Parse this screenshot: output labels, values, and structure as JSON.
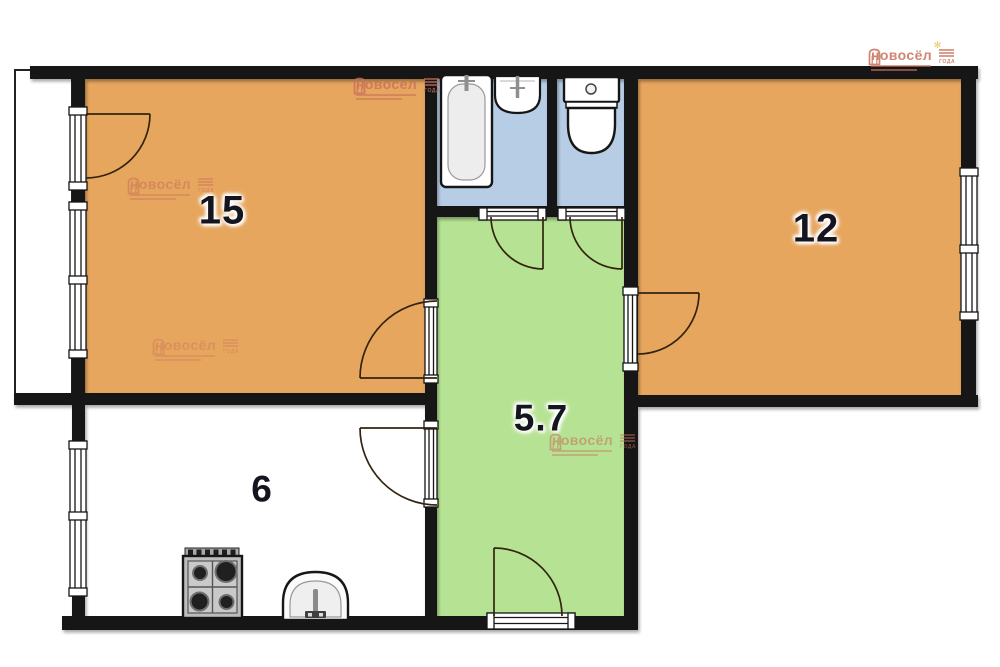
{
  "document": {
    "kind": "apartment floor plan"
  },
  "colors": {
    "room-fill": "#e7a65e",
    "hallway-fill": "#b6e393",
    "wet-fill": "#b7cde6",
    "wall": "#161616",
    "door-line": "#33240f",
    "watermark": "#c8705c",
    "label": "#15151f",
    "sparkle": "#e4bc3e"
  },
  "rooms": {
    "living": {
      "label": "15"
    },
    "bedroom": {
      "label": "12"
    },
    "hallway": {
      "label": "5.7"
    },
    "kitchen": {
      "label": "6"
    }
  },
  "watermark": {
    "brand": "новосёл",
    "badge": "ГОДА",
    "sparkle": "✻"
  },
  "fixtures": {
    "bathtub": "bathtub",
    "bath_sink": "wash basin",
    "toilet": "toilet",
    "stove": "gas stove",
    "kitchen_sink": "kitchen sink"
  }
}
